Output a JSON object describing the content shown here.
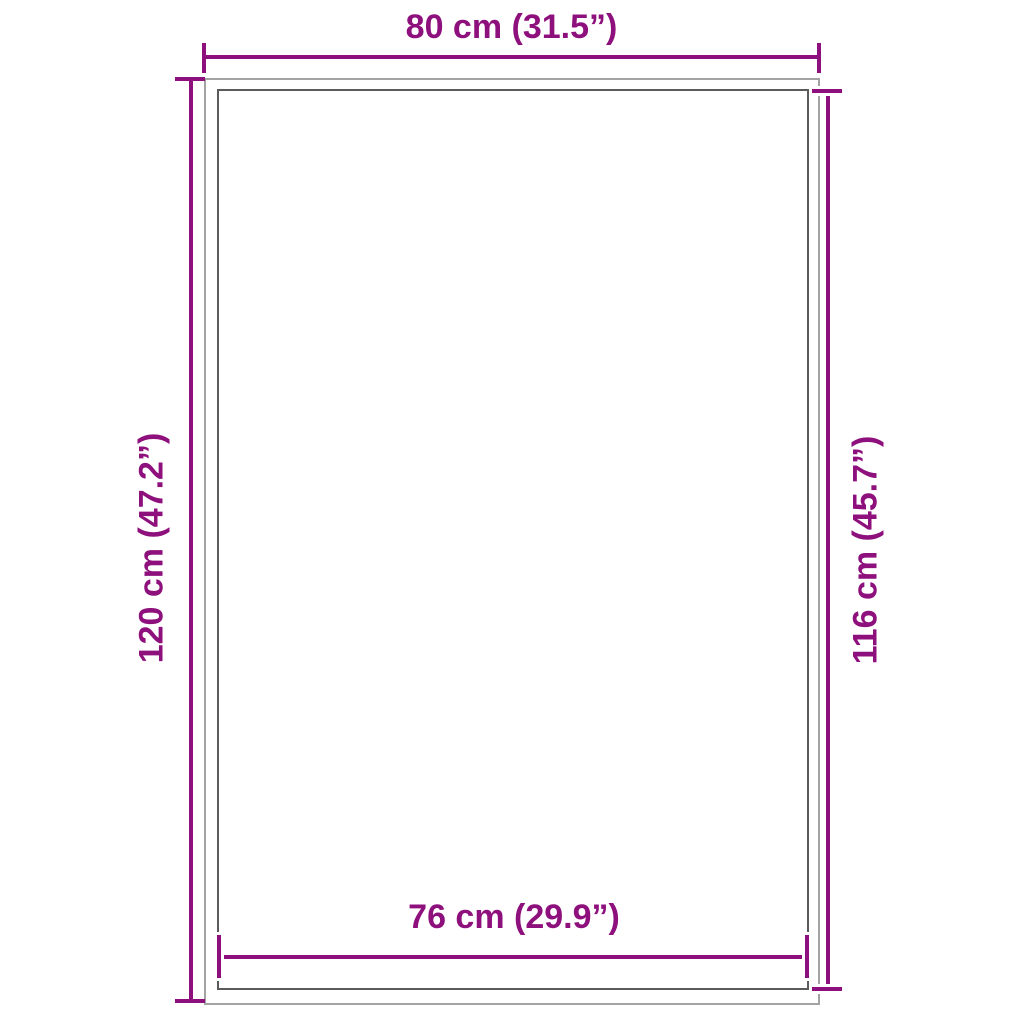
{
  "diagram": {
    "colors": {
      "accent": "#8E107C",
      "outer_outline": "#A3A3A3",
      "inner_outline": "#5B5B5B",
      "background": "#FFFFFF"
    },
    "dimensions": {
      "top": {
        "label": "80 cm (31.5”)",
        "cm": "80",
        "inches": "31.5"
      },
      "left": {
        "label": "120 cm (47.2”)",
        "cm": "120",
        "inches": "47.2"
      },
      "right": {
        "label": "116 cm (45.7”)",
        "cm": "116",
        "inches": "45.7"
      },
      "bottom": {
        "label": "76 cm (29.9”)",
        "cm": "76",
        "inches": "29.9"
      }
    }
  }
}
